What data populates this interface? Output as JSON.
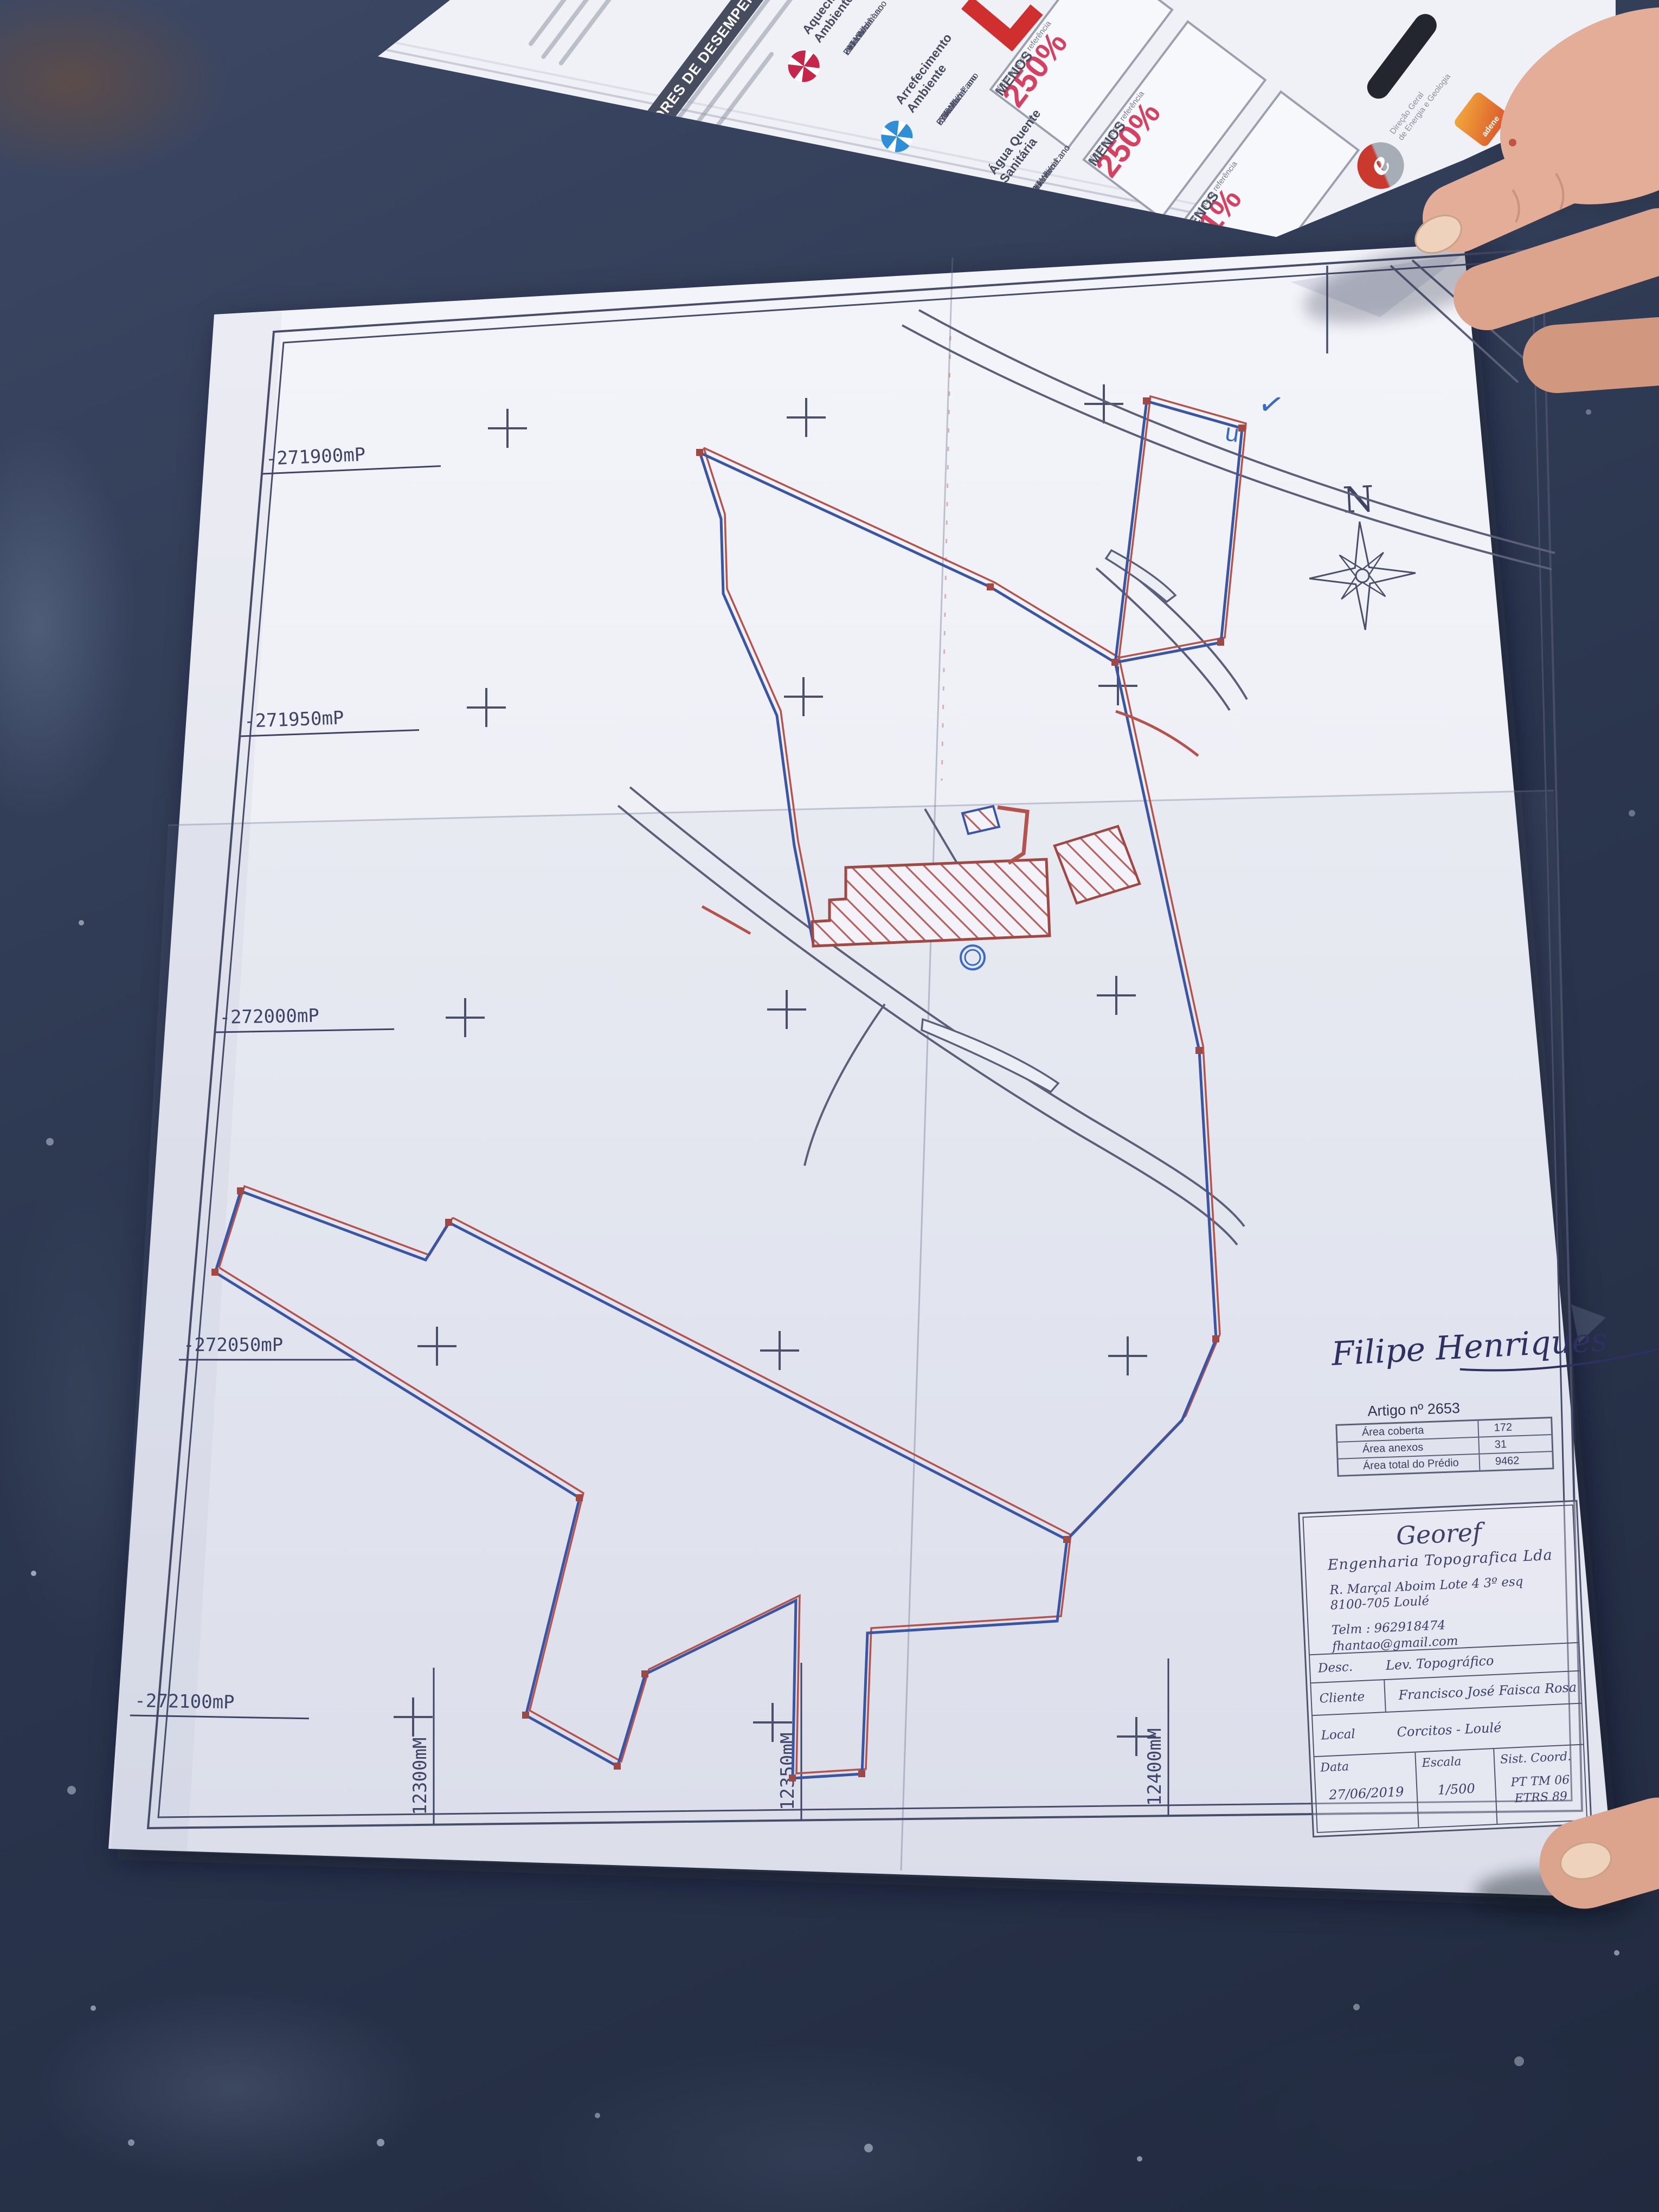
{
  "scene": {
    "table_color": "#2c3750",
    "paper_color": "#eceef5",
    "colors": {
      "boundary_blue": "#3b55a5",
      "boundary_red": "#b5524c",
      "road": "#5b6078",
      "ink": "#3f4466",
      "hatch": "#b5605c"
    }
  },
  "brochure": {
    "heading": "INDICADORES DE DESEMPENHO",
    "ref_label": "Referência:",
    "ed_label": "Edifício:",
    "ren_label": "Renovável:",
    "indicators": [
      {
        "label": "Aquecimento Ambiente",
        "color": "#c5274a",
        "ref": "74 kWh/m².ano",
        "ed": "291 kWh/m².ano",
        "ren": "- %",
        "badge_value": "250%",
        "badge_word": "MENOS",
        "badge_sub": "eficiente que a referência"
      },
      {
        "label": "Arrefecimento Ambiente",
        "color": "#2f8fd6",
        "ref": "6,3 kWh/m².ano",
        "ed": "27 kWh/m².ano",
        "ren": "- %",
        "badge_value": "250%",
        "badge_word": "MENOS",
        "badge_sub": "eficiente que a referência"
      },
      {
        "label": "Água Quente Sanitária",
        "color": "#e07b27",
        "ref": "19 kWh/m².ano",
        "ed": "21 kWh/m².ano",
        "ren": "- %",
        "badge_value": "11%",
        "badge_word": "MENOS",
        "badge_sub": "eficiente que a referência"
      }
    ],
    "dgeg_letter": "e",
    "dgeg_line1": "Direção Geral",
    "dgeg_line2": "de Energia e Geologia",
    "adene": "adene",
    "entidade_gestora": "Entidade Gestora"
  },
  "plan": {
    "north_label": "N",
    "grid_x_labels": [
      "-271900mP",
      "-271950mP",
      "-272000mP",
      "-272050mP",
      "-272100mP"
    ],
    "grid_y_labels": [
      "12300mM",
      "12350mM",
      "12400mM"
    ],
    "blue_mark_1": "✓",
    "blue_mark_2": "u",
    "signature": "Filipe Henriques",
    "artigo": {
      "title": "Artigo nº 2653",
      "rows": [
        {
          "label": "Área coberta",
          "value": "172"
        },
        {
          "label": "Área anexos",
          "value": "31"
        },
        {
          "label": "Área total do Prédio",
          "value": "9462"
        }
      ]
    },
    "titleblock": {
      "company": "Georef",
      "subtitle": "Engenharia Topografica Lda",
      "address1": "R. Marçal Aboim Lote 4 3º esq",
      "address2": "8100-705 Loulé",
      "phone": "Telm : 962918474",
      "email": "fhantao@gmail.com",
      "desc_label": "Desc.",
      "desc_value": "Lev. Topográfico",
      "client_label": "Cliente",
      "client_value": "Francisco José Faisca Rosa",
      "local_label": "Local",
      "local_value": "Corcitos - Loulé",
      "date_label": "Data",
      "date_value": "27/06/2019",
      "scale_label": "Escala",
      "scale_value": "1/500",
      "coord_label": "Sist. Coord.",
      "coord_value_1": "PT TM 06",
      "coord_value_2": "ETRS 89"
    }
  }
}
